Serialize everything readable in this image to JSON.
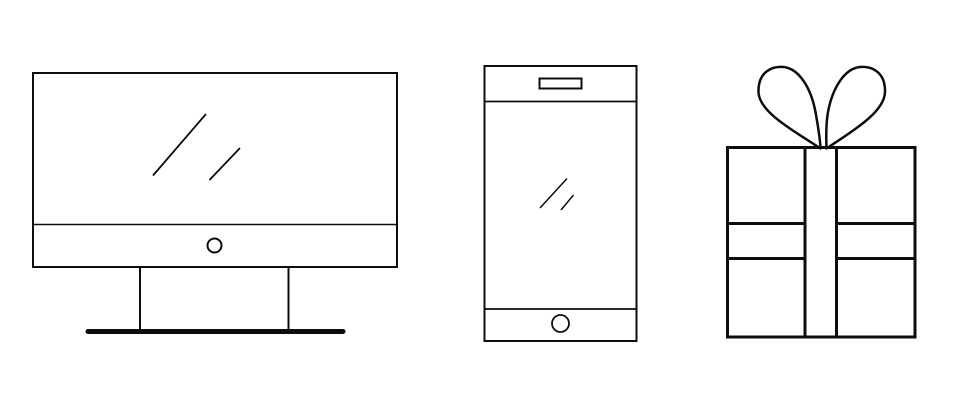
{
  "scene": {
    "title": "Line-art illustration: desktop monitor, smartphone, gift box"
  },
  "colors": {
    "stroke": "#0d0d0d",
    "background": "#ffffff"
  },
  "icons": [
    {
      "id": "monitor",
      "name": "desktop-monitor-icon"
    },
    {
      "id": "smartphone",
      "name": "smartphone-icon"
    },
    {
      "id": "gift",
      "name": "gift-box-icon"
    }
  ]
}
